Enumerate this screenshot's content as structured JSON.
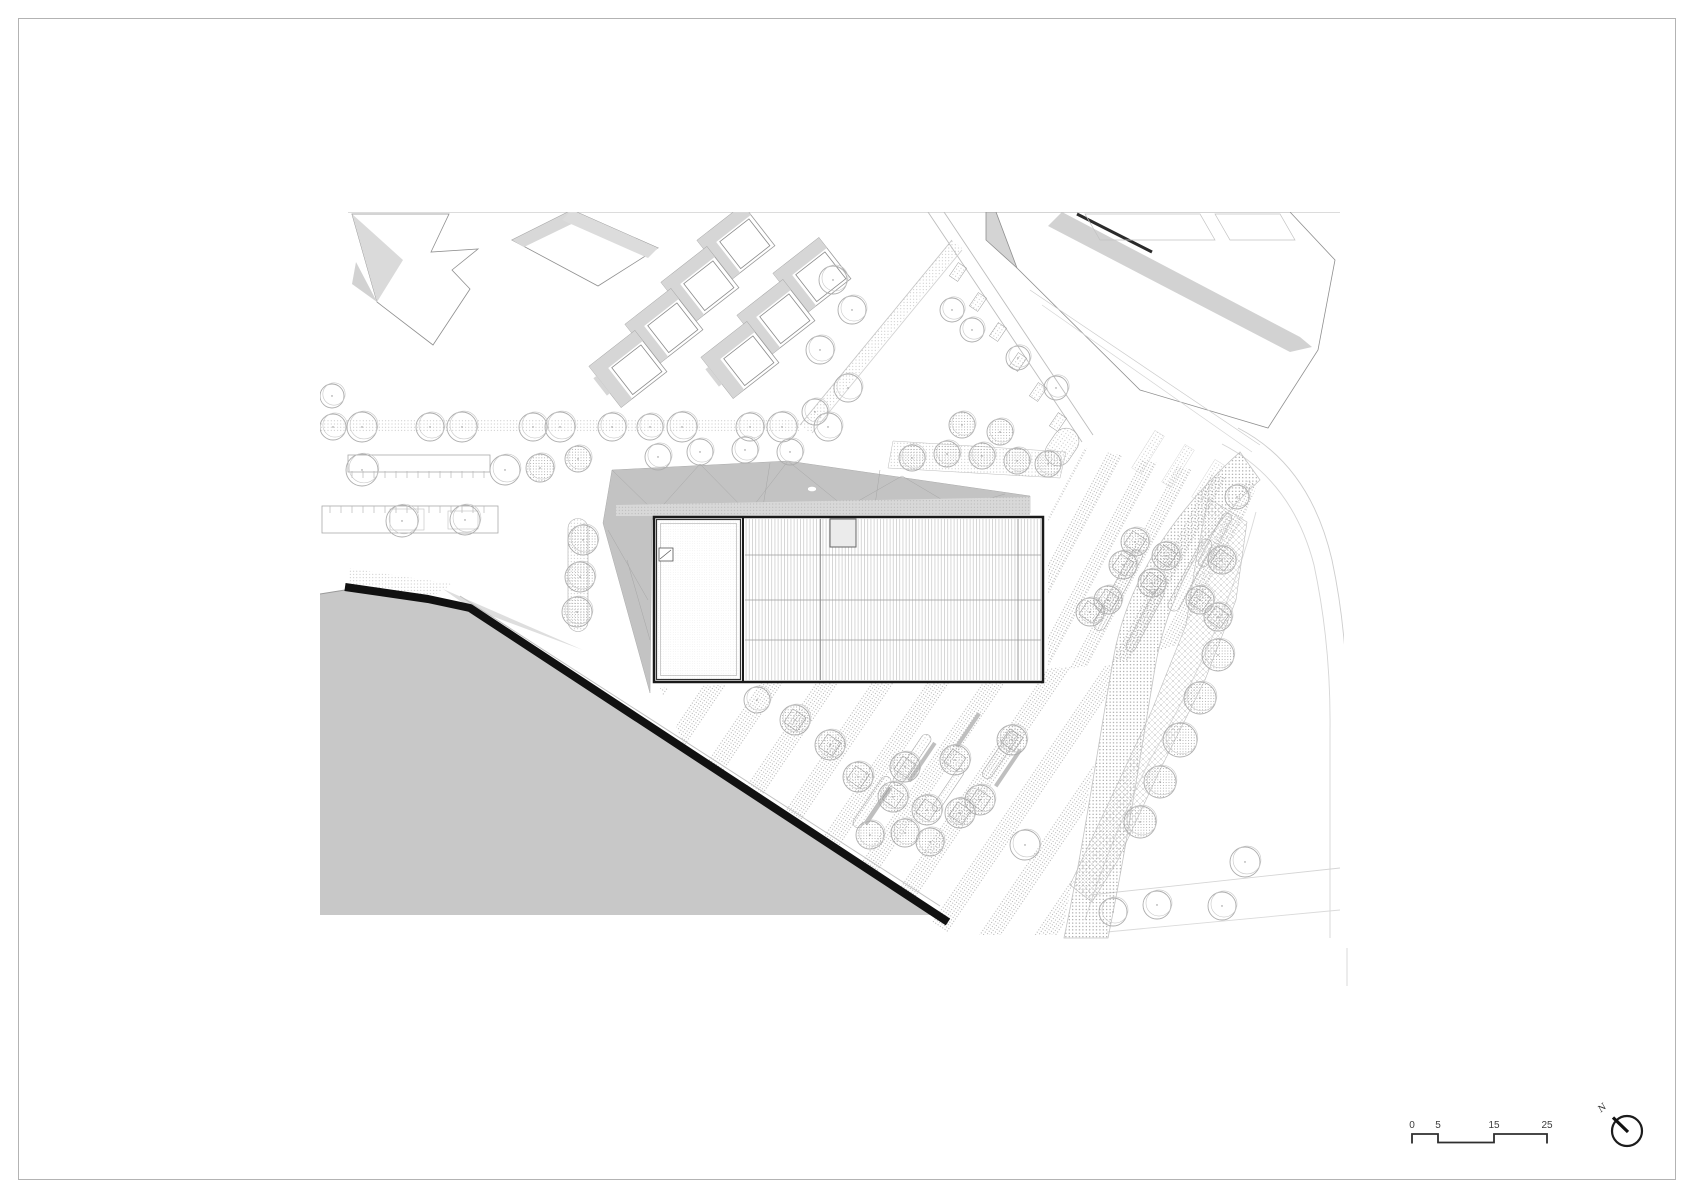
{
  "meta": {
    "sheet_name": "architectural-site-plan"
  },
  "colors": {
    "paper": "#ffffff",
    "frame": "#b3b3b3",
    "water": "#c8c8c8",
    "shoreline": "#111111",
    "canopy": "#c3c3c3",
    "context_gray": "#d6d6d6",
    "ink": "#2e2e2e"
  },
  "scalebar": {
    "labels": [
      "0",
      "5",
      "15",
      "25"
    ]
  },
  "north": {
    "label": "N"
  },
  "plan": {
    "trees_plain": [
      [
        333,
        427,
        13
      ],
      [
        362,
        427,
        15
      ],
      [
        430,
        427,
        14
      ],
      [
        462,
        427,
        15
      ],
      [
        533,
        427,
        14
      ],
      [
        560,
        427,
        15
      ],
      [
        612,
        427,
        14
      ],
      [
        650,
        427,
        13
      ],
      [
        682,
        427,
        15
      ],
      [
        750,
        427,
        14
      ],
      [
        782,
        427,
        15
      ],
      [
        828,
        427,
        14
      ],
      [
        332,
        396,
        12
      ],
      [
        362,
        470,
        16
      ],
      [
        505,
        470,
        15
      ],
      [
        402,
        521,
        16
      ],
      [
        465,
        520,
        15
      ],
      [
        658,
        457,
        13
      ],
      [
        700,
        452,
        13
      ],
      [
        745,
        450,
        13
      ],
      [
        790,
        452,
        13
      ],
      [
        833,
        280,
        14
      ],
      [
        852,
        310,
        14
      ],
      [
        820,
        350,
        14
      ],
      [
        848,
        388,
        14
      ],
      [
        815,
        412,
        13
      ],
      [
        952,
        310,
        12
      ],
      [
        972,
        330,
        12
      ],
      [
        1018,
        358,
        12
      ],
      [
        1056,
        388,
        12
      ],
      [
        757,
        700,
        13
      ],
      [
        1237,
        497,
        12
      ],
      [
        1025,
        845,
        15
      ],
      [
        1113,
        912,
        14
      ],
      [
        1157,
        905,
        14
      ],
      [
        1245,
        862,
        15
      ],
      [
        1222,
        906,
        14
      ]
    ],
    "trees_speckled": [
      [
        583,
        540,
        15
      ],
      [
        580,
        577,
        15
      ],
      [
        577,
        612,
        15
      ],
      [
        540,
        468,
        14
      ],
      [
        578,
        459,
        13
      ],
      [
        912,
        458,
        13
      ],
      [
        947,
        454,
        13
      ],
      [
        982,
        456,
        13
      ],
      [
        1017,
        461,
        13
      ],
      [
        1048,
        464,
        13
      ],
      [
        962,
        425,
        13
      ],
      [
        1000,
        432,
        13
      ],
      [
        1218,
        655,
        16
      ],
      [
        1200,
        698,
        16
      ],
      [
        1180,
        740,
        17
      ],
      [
        1160,
        782,
        16
      ],
      [
        1140,
        822,
        16
      ],
      [
        905,
        833,
        14
      ],
      [
        870,
        835,
        14
      ],
      [
        930,
        842,
        14
      ]
    ],
    "trees_planter": [
      [
        858,
        777,
        15
      ],
      [
        893,
        797,
        15
      ],
      [
        905,
        767,
        15
      ],
      [
        927,
        810,
        15
      ],
      [
        955,
        760,
        15
      ],
      [
        960,
        813,
        15
      ],
      [
        980,
        800,
        15
      ],
      [
        1012,
        740,
        15
      ],
      [
        795,
        720,
        15
      ],
      [
        830,
        745,
        15
      ],
      [
        1090,
        612,
        14
      ],
      [
        1108,
        600,
        14
      ],
      [
        1123,
        565,
        14
      ],
      [
        1135,
        542,
        14
      ],
      [
        1152,
        583,
        14
      ],
      [
        1166,
        556,
        14
      ],
      [
        1200,
        600,
        14
      ],
      [
        1222,
        560,
        14
      ],
      [
        1218,
        617,
        14
      ]
    ],
    "strips": [
      [
        912,
        760,
        10,
        60,
        34
      ],
      [
        872,
        802,
        10,
        60,
        34
      ],
      [
        1000,
        755,
        10,
        55,
        34
      ],
      [
        948,
        790,
        8,
        50,
        34
      ],
      [
        1118,
        590,
        12,
        90,
        28
      ],
      [
        1145,
        620,
        10,
        70,
        28
      ],
      [
        1190,
        575,
        12,
        80,
        28
      ],
      [
        1215,
        540,
        10,
        60,
        28
      ],
      [
        578,
        575,
        20,
        113,
        0
      ],
      [
        1062,
        447,
        26,
        40,
        34
      ]
    ],
    "benches": [
      [
        922,
        762,
        4,
        46,
        34
      ],
      [
        878,
        806,
        4,
        44,
        34
      ],
      [
        1008,
        768,
        4,
        44,
        34
      ],
      [
        968,
        730,
        4,
        40,
        34
      ]
    ],
    "street_planters": [
      [
        958,
        272
      ],
      [
        978,
        302
      ],
      [
        998,
        332
      ],
      [
        1018,
        362
      ],
      [
        1038,
        392
      ],
      [
        1058,
        422
      ]
    ],
    "crosswalks": [
      [
        1148,
        452
      ],
      [
        1178,
        466
      ],
      [
        1208,
        481
      ]
    ],
    "tick_rows": [
      {
        "x0": 352,
        "x1": 486,
        "step": 11,
        "y0": 471,
        "y1": 478
      },
      {
        "x0": 330,
        "x1": 490,
        "step": 11,
        "y0": 506,
        "y1": 513
      }
    ]
  }
}
